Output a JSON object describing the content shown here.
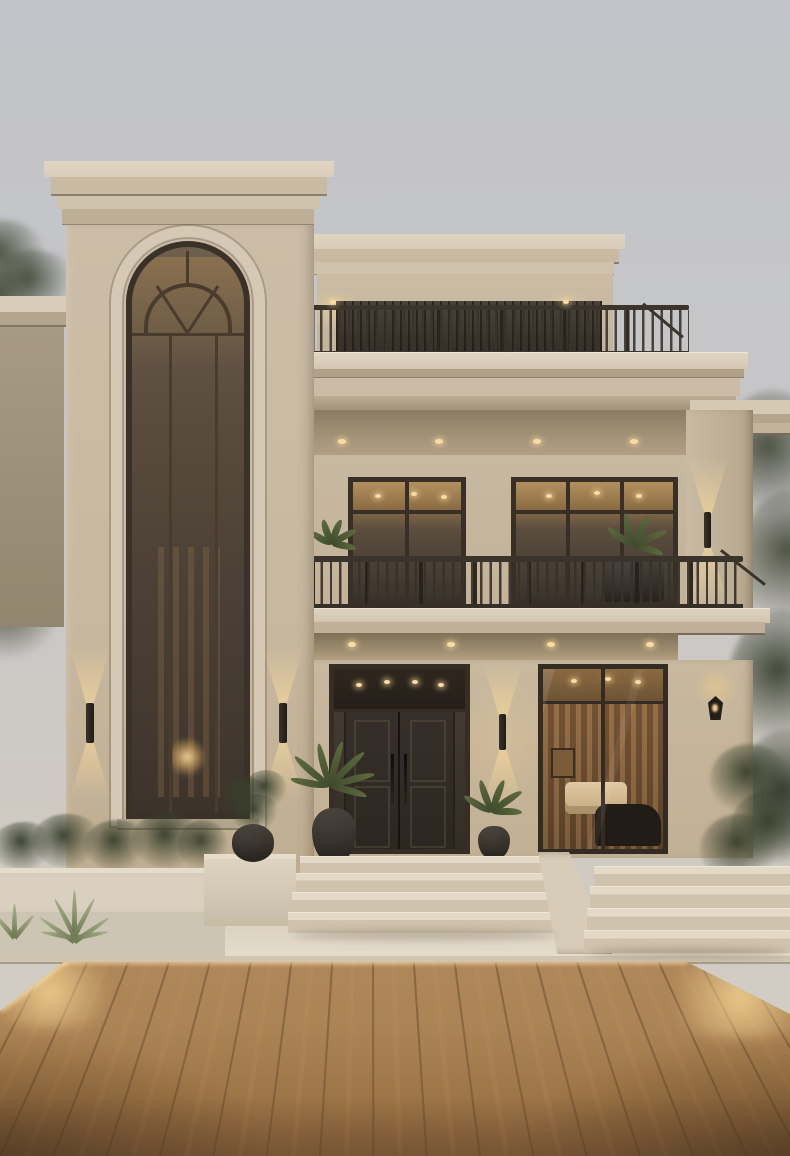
{
  "scene": {
    "description": "Three-story modern classical villa at dusk with a tall arched tower window, roof terrace, lit balcony, dark double entry door, warm interior lighting, stone steps and an LED-edged wooden deck",
    "time_of_day": "dusk"
  },
  "palette": {
    "sky_top": "#c2c3c8",
    "sky_bottom": "#cfcac2",
    "stucco": "#cbbda7",
    "stucco_shadow": "#b4a68f",
    "cornice_light": "#d9cdb9",
    "cornice_dark": "#6e6253",
    "frame_dark": "#3a3128",
    "glass_warm": "#8a6a45",
    "interior_glow": "#e8c48c",
    "railing": "#3c352c",
    "door_dark": "#2e2721",
    "deck_mid": "#ab8253",
    "deck_gap": "#6b5133",
    "concrete": "#ddd5c4",
    "led_glow": "#f6dba2",
    "downlight": "#f7dca6",
    "plant_dark": "#3d4430",
    "plant_mid": "#55603f",
    "tree_olive": "#4a4f3c"
  },
  "counts": {
    "floors": 3,
    "soffit_downlights_upper": 4,
    "soffit_downlights_lower": 4,
    "entry_steps": 4,
    "side_steps": 4,
    "wall_sconces": 6,
    "balcony_windows": 2,
    "balcony_planters": 2,
    "entry_palms": 2
  },
  "deck": {
    "plank_count": 28
  }
}
